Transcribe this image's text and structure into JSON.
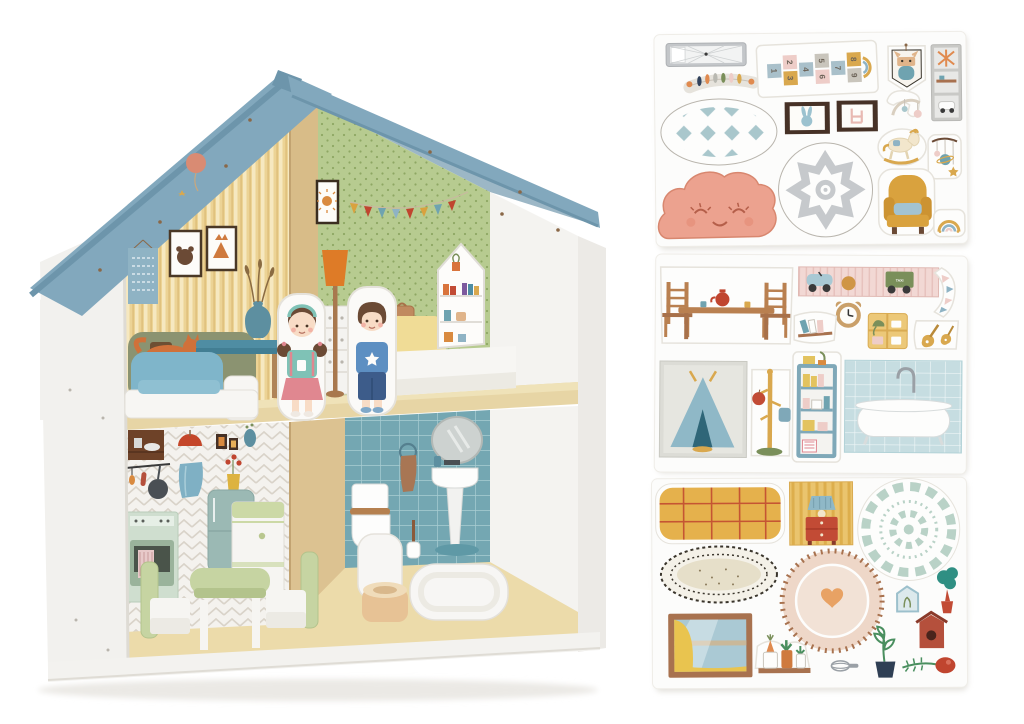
{
  "scene": {
    "type": "product-photo",
    "description": "Wooden two-storey dollhouse with blue roof, furnished rooms, two wooden peg dolls, and three sheets of furniture stickers",
    "background": "#ffffff"
  },
  "palette": {
    "roof": "#82a8bd",
    "roof_edge": "#6d95ab",
    "roof_underside": "#9cb7c6",
    "wall_white": "#f2f1ee",
    "interior_white": "#f4f3f0",
    "wood_floor": "#e7d5a5",
    "wood_divider": "#d8bc88",
    "wallpaper_yellow": "#ecd395",
    "wallpaper_green": "#b7cb90",
    "tile_teal": "#74a7b2",
    "herringbone_white": "#f4f2ee",
    "accent_red": "#c0452f",
    "accent_mustard": "#d9a23e",
    "accent_teal": "#6fa3b0",
    "accent_orange": "#de7b27",
    "cloud_pink": "#eca28f",
    "skin": "#f8dcc6",
    "hair_brown": "#6b4a35",
    "girl_top": "#7fc2b6",
    "girl_skirt": "#e08790",
    "boy_shirt": "#5d8fc2",
    "boy_pants": "#3d5c8a",
    "furniture_green": "#c6d4a2",
    "bed_blue": "#7fb5ca",
    "bed_yellow": "#f0dc96",
    "armchair_mustard": "#d9a23e"
  },
  "dollhouse": {
    "floors": 2,
    "rooms": [
      {
        "name": "living-bedroom",
        "wallpaper": "yellow stripes",
        "decor": [
          "alphabet-chart",
          "bear-picture",
          "fox-picture",
          "balloon-print",
          "sofa-with-fox-print",
          "vase-with-grasses-print"
        ],
        "furniture": [
          "blue-coffee-table",
          "white-bed-with-blue-bedding"
        ]
      },
      {
        "name": "kids-bedroom",
        "wallpaper": "green polka dots",
        "decor": [
          "sun-picture",
          "flag-banner"
        ],
        "furniture": [
          "orange-floor-lamp",
          "white-dresser",
          "suitcase",
          "yellow-bed-with-white-mattress",
          "house-shaped-bookshelf"
        ]
      },
      {
        "name": "kitchen",
        "wallpaper": "white herringbone",
        "decor": [
          "dish-shelf-print",
          "pendant-lamp-print",
          "frame-prints",
          "vase-print",
          "utensil-rail-print",
          "frying-pan-print",
          "towel-print",
          "flower-vase-print",
          "oven-print",
          "fridge-print"
        ],
        "furniture": [
          "white-green-fridge",
          "green-table",
          "green-chair-left",
          "green-chair-right"
        ]
      },
      {
        "name": "bathroom",
        "wallpaper": "teal tiles",
        "decor": [
          "mirror-print",
          "towel-ring-print",
          "pedestal-sink-print",
          "toilet-print",
          "toilet-brush-print"
        ],
        "furniture": [
          "wooden-toilet",
          "white-bathtub"
        ]
      }
    ],
    "dolls": [
      {
        "name": "girl-doll",
        "hair": "brown pigtails",
        "top": "#7fc2b6",
        "skirt": "#e08790"
      },
      {
        "name": "boy-doll",
        "hair": "brown",
        "shirt": "#5d8fc2",
        "pants": "#3d5c8a"
      }
    ]
  },
  "sheets": {
    "sheet1": {
      "label": "sticker sheet 1 - nursery",
      "items": [
        "skylight-window",
        "feather-garland",
        "hopscotch-mat",
        "cat-pennant",
        "wall-prints-strip",
        "diamond-oval-rug",
        "bunny-frame",
        "chair-frame",
        "mobile-arm",
        "rocking-horse",
        "planet-mobile",
        "mandala-round-rug",
        "sleepy-cloud",
        "yellow-armchair",
        "rainbow"
      ],
      "hopscotch": {
        "numbers": [
          "1",
          "2",
          "3",
          "4",
          "5",
          "6",
          "7",
          "8",
          "9"
        ]
      }
    },
    "sheet2": {
      "label": "sticker sheet 2 - furniture",
      "items": [
        "dining-table-set",
        "toy-shelf",
        "curved-pennant-banner",
        "bear-clock",
        "book-shelf",
        "yellow-cabinet",
        "guitars",
        "teepee-poster",
        "coat-rack",
        "blue-bookshelf",
        "bathtub-on-tiles"
      ],
      "wagon_label": "TAXI"
    },
    "sheet3": {
      "label": "sticker sheet 3 - living room",
      "items": [
        "plaid-blanket",
        "nightstand-panel",
        "doily-rug",
        "oval-rug",
        "stitched-round-rug",
        "house-frame",
        "tree",
        "window-with-curtain",
        "plant-shelf",
        "whisk",
        "sprout-pot",
        "birdhouse",
        "rattle-sprig"
      ]
    }
  }
}
